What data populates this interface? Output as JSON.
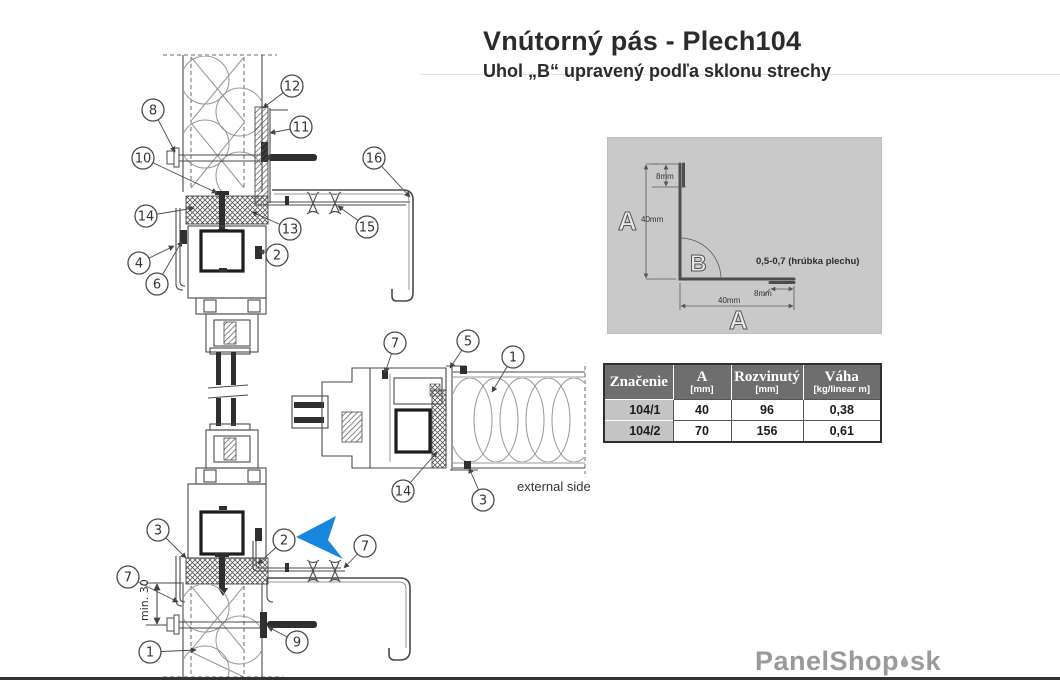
{
  "title": {
    "main": "Vnútorný pás - Plech104",
    "subtitle": "Uhol „B“ upravený podľa sklonu strechy"
  },
  "profile": {
    "letter_a_left": "A",
    "letter_a_bottom": "A",
    "letter_b": "B",
    "dim_hem_top": "8mm",
    "dim_leg_vertical": "40mm",
    "dim_leg_horizontal": "40mm",
    "dim_hem_right": "8mm",
    "thickness_note": "0,5-0,7 (hrúbka plechu)",
    "bg_color": "#c9c9c9"
  },
  "table": {
    "headers": [
      {
        "l1": "Značenie",
        "l2": ""
      },
      {
        "l1": "A",
        "l2": "[mm]"
      },
      {
        "l1": "Rozvinutý",
        "l2": "[mm]"
      },
      {
        "l1": "Váha",
        "l2": "[kg/linear m]"
      }
    ],
    "rows": [
      {
        "znacenie": "104/1",
        "a": "40",
        "rozvinuty": "96",
        "vaha": "0,38"
      },
      {
        "znacenie": "104/2",
        "a": "70",
        "rozvinuty": "156",
        "vaha": "0,61"
      }
    ],
    "header_bg": "#6e6e6e",
    "row_label_bg": "#c4c4c4"
  },
  "drawing": {
    "external_side_label": "external side",
    "min_dimension_label": "min. 30",
    "arrow_color": "#1787dd",
    "callouts": [
      {
        "label": "8",
        "cx": 153,
        "cy": 110,
        "tx": 175,
        "ty": 152
      },
      {
        "label": "12",
        "cx": 292,
        "cy": 86,
        "tx": 263,
        "ty": 108
      },
      {
        "label": "11",
        "cx": 301,
        "cy": 127,
        "tx": 270,
        "ty": 133
      },
      {
        "label": "10",
        "cx": 143,
        "cy": 158,
        "tx": 217,
        "ty": 193
      },
      {
        "label": "16",
        "cx": 374,
        "cy": 158,
        "tx": 410,
        "ty": 197
      },
      {
        "label": "14",
        "cx": 146,
        "cy": 216,
        "tx": 194,
        "ty": 208
      },
      {
        "label": "13",
        "cx": 290,
        "cy": 229,
        "tx": 252,
        "ty": 212
      },
      {
        "label": "15",
        "cx": 367,
        "cy": 227,
        "tx": 338,
        "ty": 206
      },
      {
        "label": "4",
        "cx": 139,
        "cy": 263,
        "tx": 174,
        "ty": 246
      },
      {
        "label": "2",
        "cx": 277,
        "cy": 255,
        "tx": 259,
        "ty": 251
      },
      {
        "label": "6",
        "cx": 157,
        "cy": 284,
        "tx": 182,
        "ty": 241
      },
      {
        "label": "7",
        "cx": 395,
        "cy": 343,
        "tx": 385,
        "ty": 373
      },
      {
        "label": "5",
        "cx": 468,
        "cy": 341,
        "tx": 450,
        "ty": 368
      },
      {
        "label": "1",
        "cx": 513,
        "cy": 357,
        "tx": 492,
        "ty": 392
      },
      {
        "label": "14",
        "cx": 403,
        "cy": 491,
        "tx": 437,
        "ty": 452
      },
      {
        "label": "3",
        "cx": 483,
        "cy": 500,
        "tx": 469,
        "ty": 468
      },
      {
        "label": "3",
        "cx": 158,
        "cy": 530,
        "tx": 186,
        "ty": 558
      },
      {
        "label": "2",
        "cx": 284,
        "cy": 540,
        "tx": 258,
        "ty": 564
      },
      {
        "label": "7",
        "cx": 365,
        "cy": 546,
        "tx": 344,
        "ty": 568
      },
      {
        "label": "7",
        "cx": 128,
        "cy": 577,
        "tx": 178,
        "ty": 602
      },
      {
        "label": "9",
        "cx": 297,
        "cy": 642,
        "tx": 268,
        "ty": 627
      },
      {
        "label": "1",
        "cx": 150,
        "cy": 652,
        "tx": 196,
        "ty": 650
      }
    ]
  },
  "logo": {
    "name": "PanelShop",
    "tld": "sk"
  }
}
